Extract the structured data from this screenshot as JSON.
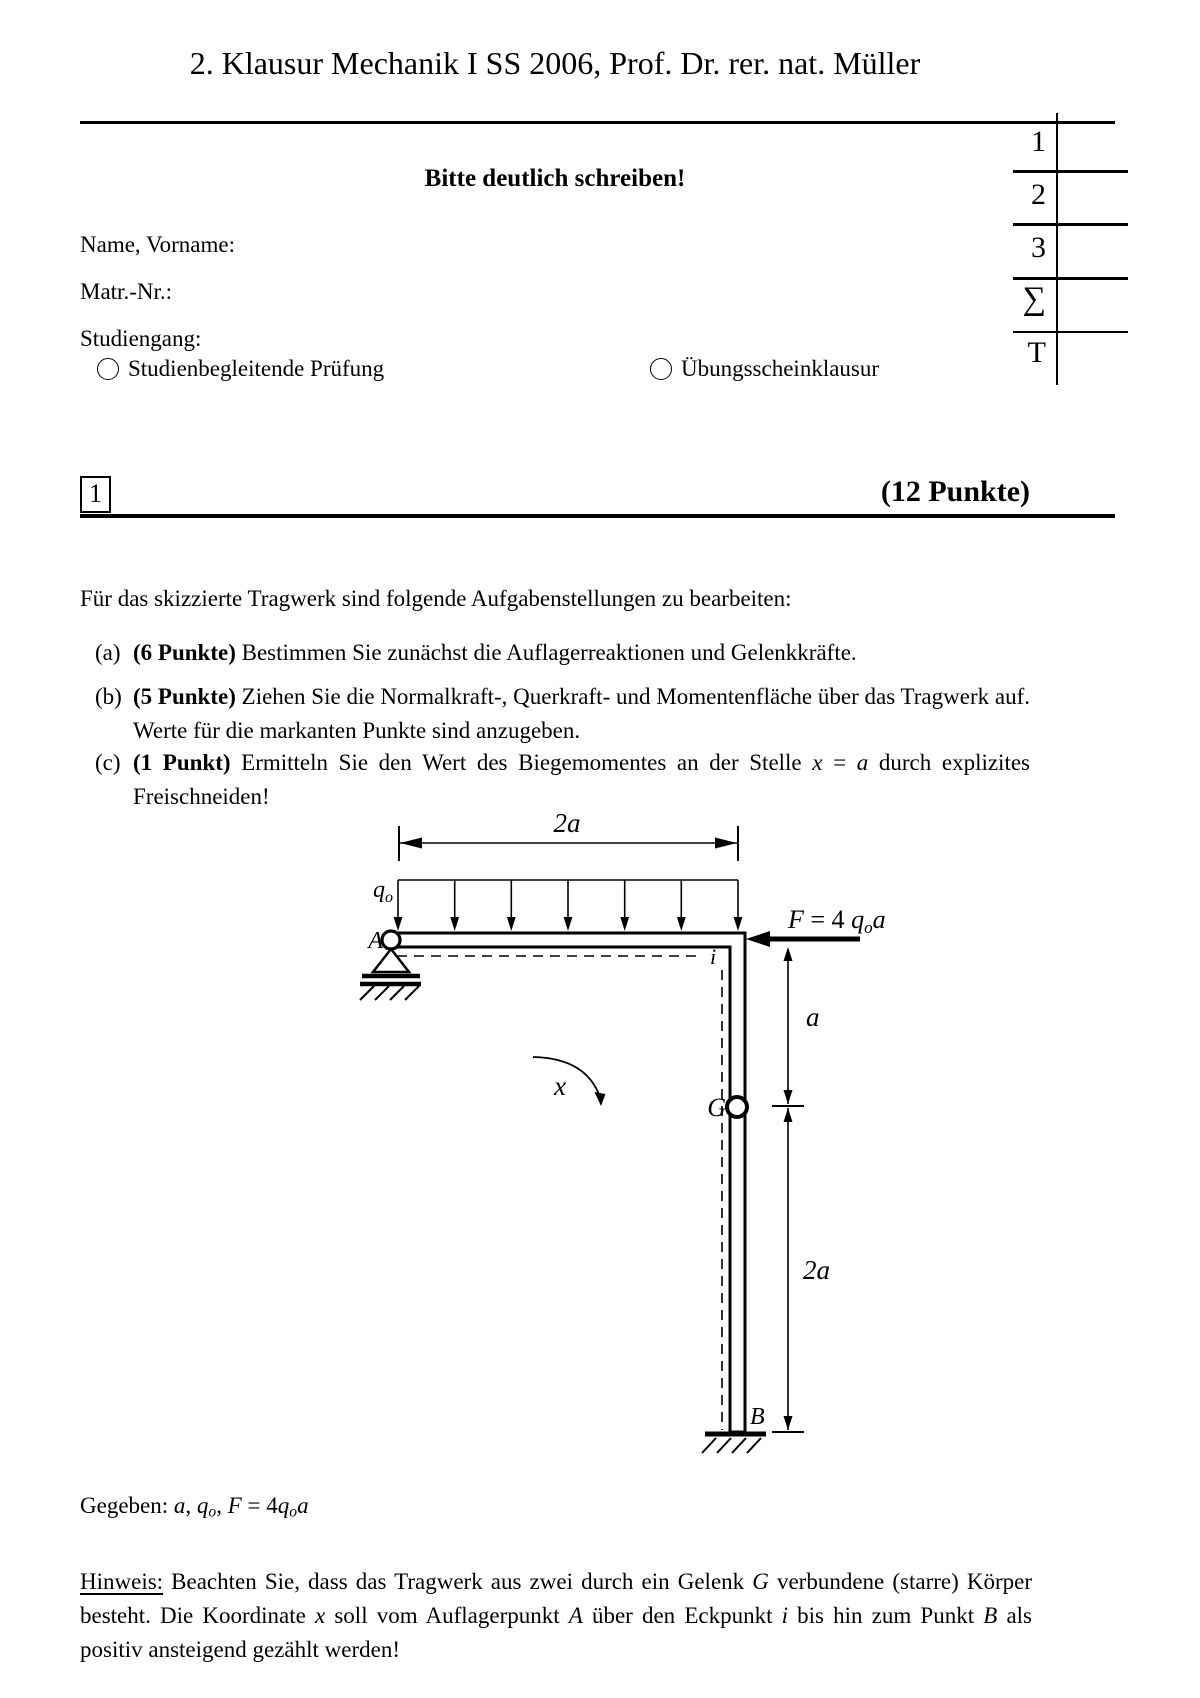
{
  "page": {
    "title": "2. Klausur Mechanik I SS 2006, Prof. Dr. rer. nat. Müller"
  },
  "header": {
    "notice": "Bitte deutlich schreiben!",
    "fields": [
      {
        "label": "Name, Vorname:"
      },
      {
        "label": "Matr.-Nr.:"
      },
      {
        "label": "Studiengang:"
      }
    ],
    "options": [
      {
        "label": "Studienbegleitende Prüfung"
      },
      {
        "label": "Übungsscheinklausur"
      }
    ],
    "grading_table": {
      "rows": [
        "1",
        "2",
        "3",
        "∑",
        "T"
      ]
    }
  },
  "section": {
    "number": "1",
    "points": "(12 Punkte)"
  },
  "task": {
    "intro": "Für das skizzierte Tragwerk sind folgende Aufgabenstellungen zu bearbeiten:",
    "items": [
      {
        "label": "(a)",
        "points": "(6 Punkte)",
        "text": " Bestimmen Sie zunächst die Auflagerreaktionen und Gelenkkräfte."
      },
      {
        "label": "(b)",
        "points": "(5 Punkte)",
        "text": " Ziehen Sie die Normalkraft-, Querkraft- und Momentenfläche über das Tragwerk auf. Werte für die markanten Punkte sind anzugeben."
      },
      {
        "label": "(c)",
        "points": "(1 Punkt)",
        "segments": [
          {
            "t": " Ermitteln Sie den Wert des Biegemomentes an der Stelle "
          },
          {
            "t": "x",
            "i": true
          },
          {
            "t": " = "
          },
          {
            "t": "a",
            "i": true
          },
          {
            "t": " durch explizites Freischneiden!"
          }
        ]
      }
    ]
  },
  "diagram": {
    "dim_top": "2a",
    "dim_mid": "a",
    "dim_bottom": "2a",
    "coord": "x",
    "corner": "i",
    "hinge": "G",
    "support_a": "A",
    "support_b": "B",
    "load": {
      "q": "q",
      "sub": "o"
    },
    "force": {
      "f": "F",
      "eq": " = 4 ",
      "q": "q",
      "sub": "o",
      "a": "a"
    }
  },
  "given": {
    "segments": [
      {
        "t": "Gegeben: "
      },
      {
        "t": "a",
        "i": true
      },
      {
        "t": ", "
      },
      {
        "t": "q",
        "i": true
      },
      {
        "t": "o",
        "i": true,
        "sub": true
      },
      {
        "t": ", "
      },
      {
        "t": "F",
        "i": true
      },
      {
        "t": " = 4"
      },
      {
        "t": "q",
        "i": true
      },
      {
        "t": "o",
        "i": true,
        "sub": true
      },
      {
        "t": "a",
        "i": true
      }
    ]
  },
  "hint": {
    "label": "Hinweis:",
    "segments": [
      {
        "t": " Beachten Sie, dass das Tragwerk aus zwei durch ein Gelenk "
      },
      {
        "t": "G",
        "i": true
      },
      {
        "t": " verbundene (starre) Körper besteht. Die Koordinate "
      },
      {
        "t": "x",
        "i": true
      },
      {
        "t": " soll vom Auflagerpunkt "
      },
      {
        "t": "A",
        "i": true
      },
      {
        "t": " über den Eckpunkt "
      },
      {
        "t": "i",
        "i": true
      },
      {
        "t": " bis hin zum Punkt "
      },
      {
        "t": "B",
        "i": true
      },
      {
        "t": " als positiv ansteigend gezählt werden!"
      }
    ]
  }
}
